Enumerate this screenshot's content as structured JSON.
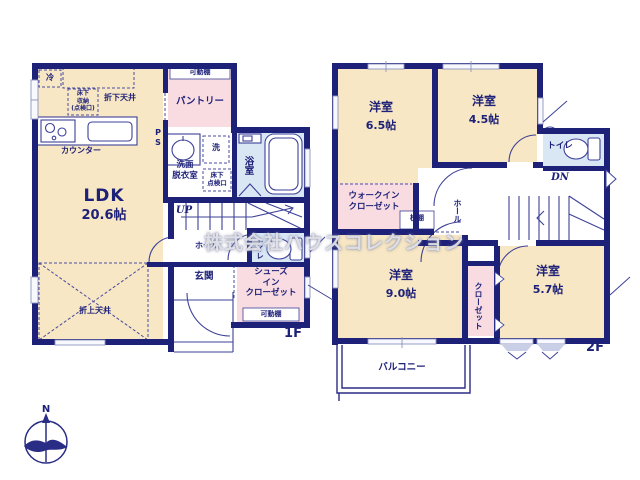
{
  "watermark": "株式会社ハウスコレクション",
  "compass_n": "N",
  "colors": {
    "wall": "#1e2178",
    "line": "#3d4198",
    "room_cream": "#f7e7c4",
    "closet_pink": "#f9dce1",
    "wet_blue": "#d9e7f5",
    "text_navy": "#1e2178"
  },
  "f1": {
    "floor_label": "1F",
    "ldk_name": "LDK",
    "ldk_size": "20.6帖",
    "pantry": "パントリー",
    "kadoudana_pantry": "可動棚",
    "rei": "冷",
    "yukashita_shuno": "床下\n収納\n(点検口)",
    "orishita_tenjo": "折下天井",
    "counter": "カウンター",
    "ps": "P\nS",
    "washer": "洗",
    "senmen": "洗面\n脱衣室",
    "yukashita_tenken": "床下\n点検口",
    "bath": "浴室",
    "up": "UP",
    "hall": "ホール",
    "toilet": "トイレ",
    "genkan": "玄関",
    "sic": "シューズ\nイン\nクローゼット",
    "kadoudana_sic": "可動棚",
    "oriage_tenjo": "折上天井"
  },
  "f2": {
    "floor_label": "2F",
    "room65_name": "洋室",
    "room65_size": "6.5帖",
    "room45_name": "洋室",
    "room45_size": "4.5帖",
    "toilet": "トイレ",
    "dn": "DN",
    "hall": "ホール",
    "wic": "ウォークイン\nクローゼット",
    "makuradana": "枕棚",
    "room90_name": "洋室",
    "room90_size": "9.0帖",
    "closet": "クローゼット",
    "room57_name": "洋室",
    "room57_size": "5.7帖",
    "balcony": "バルコニー"
  }
}
